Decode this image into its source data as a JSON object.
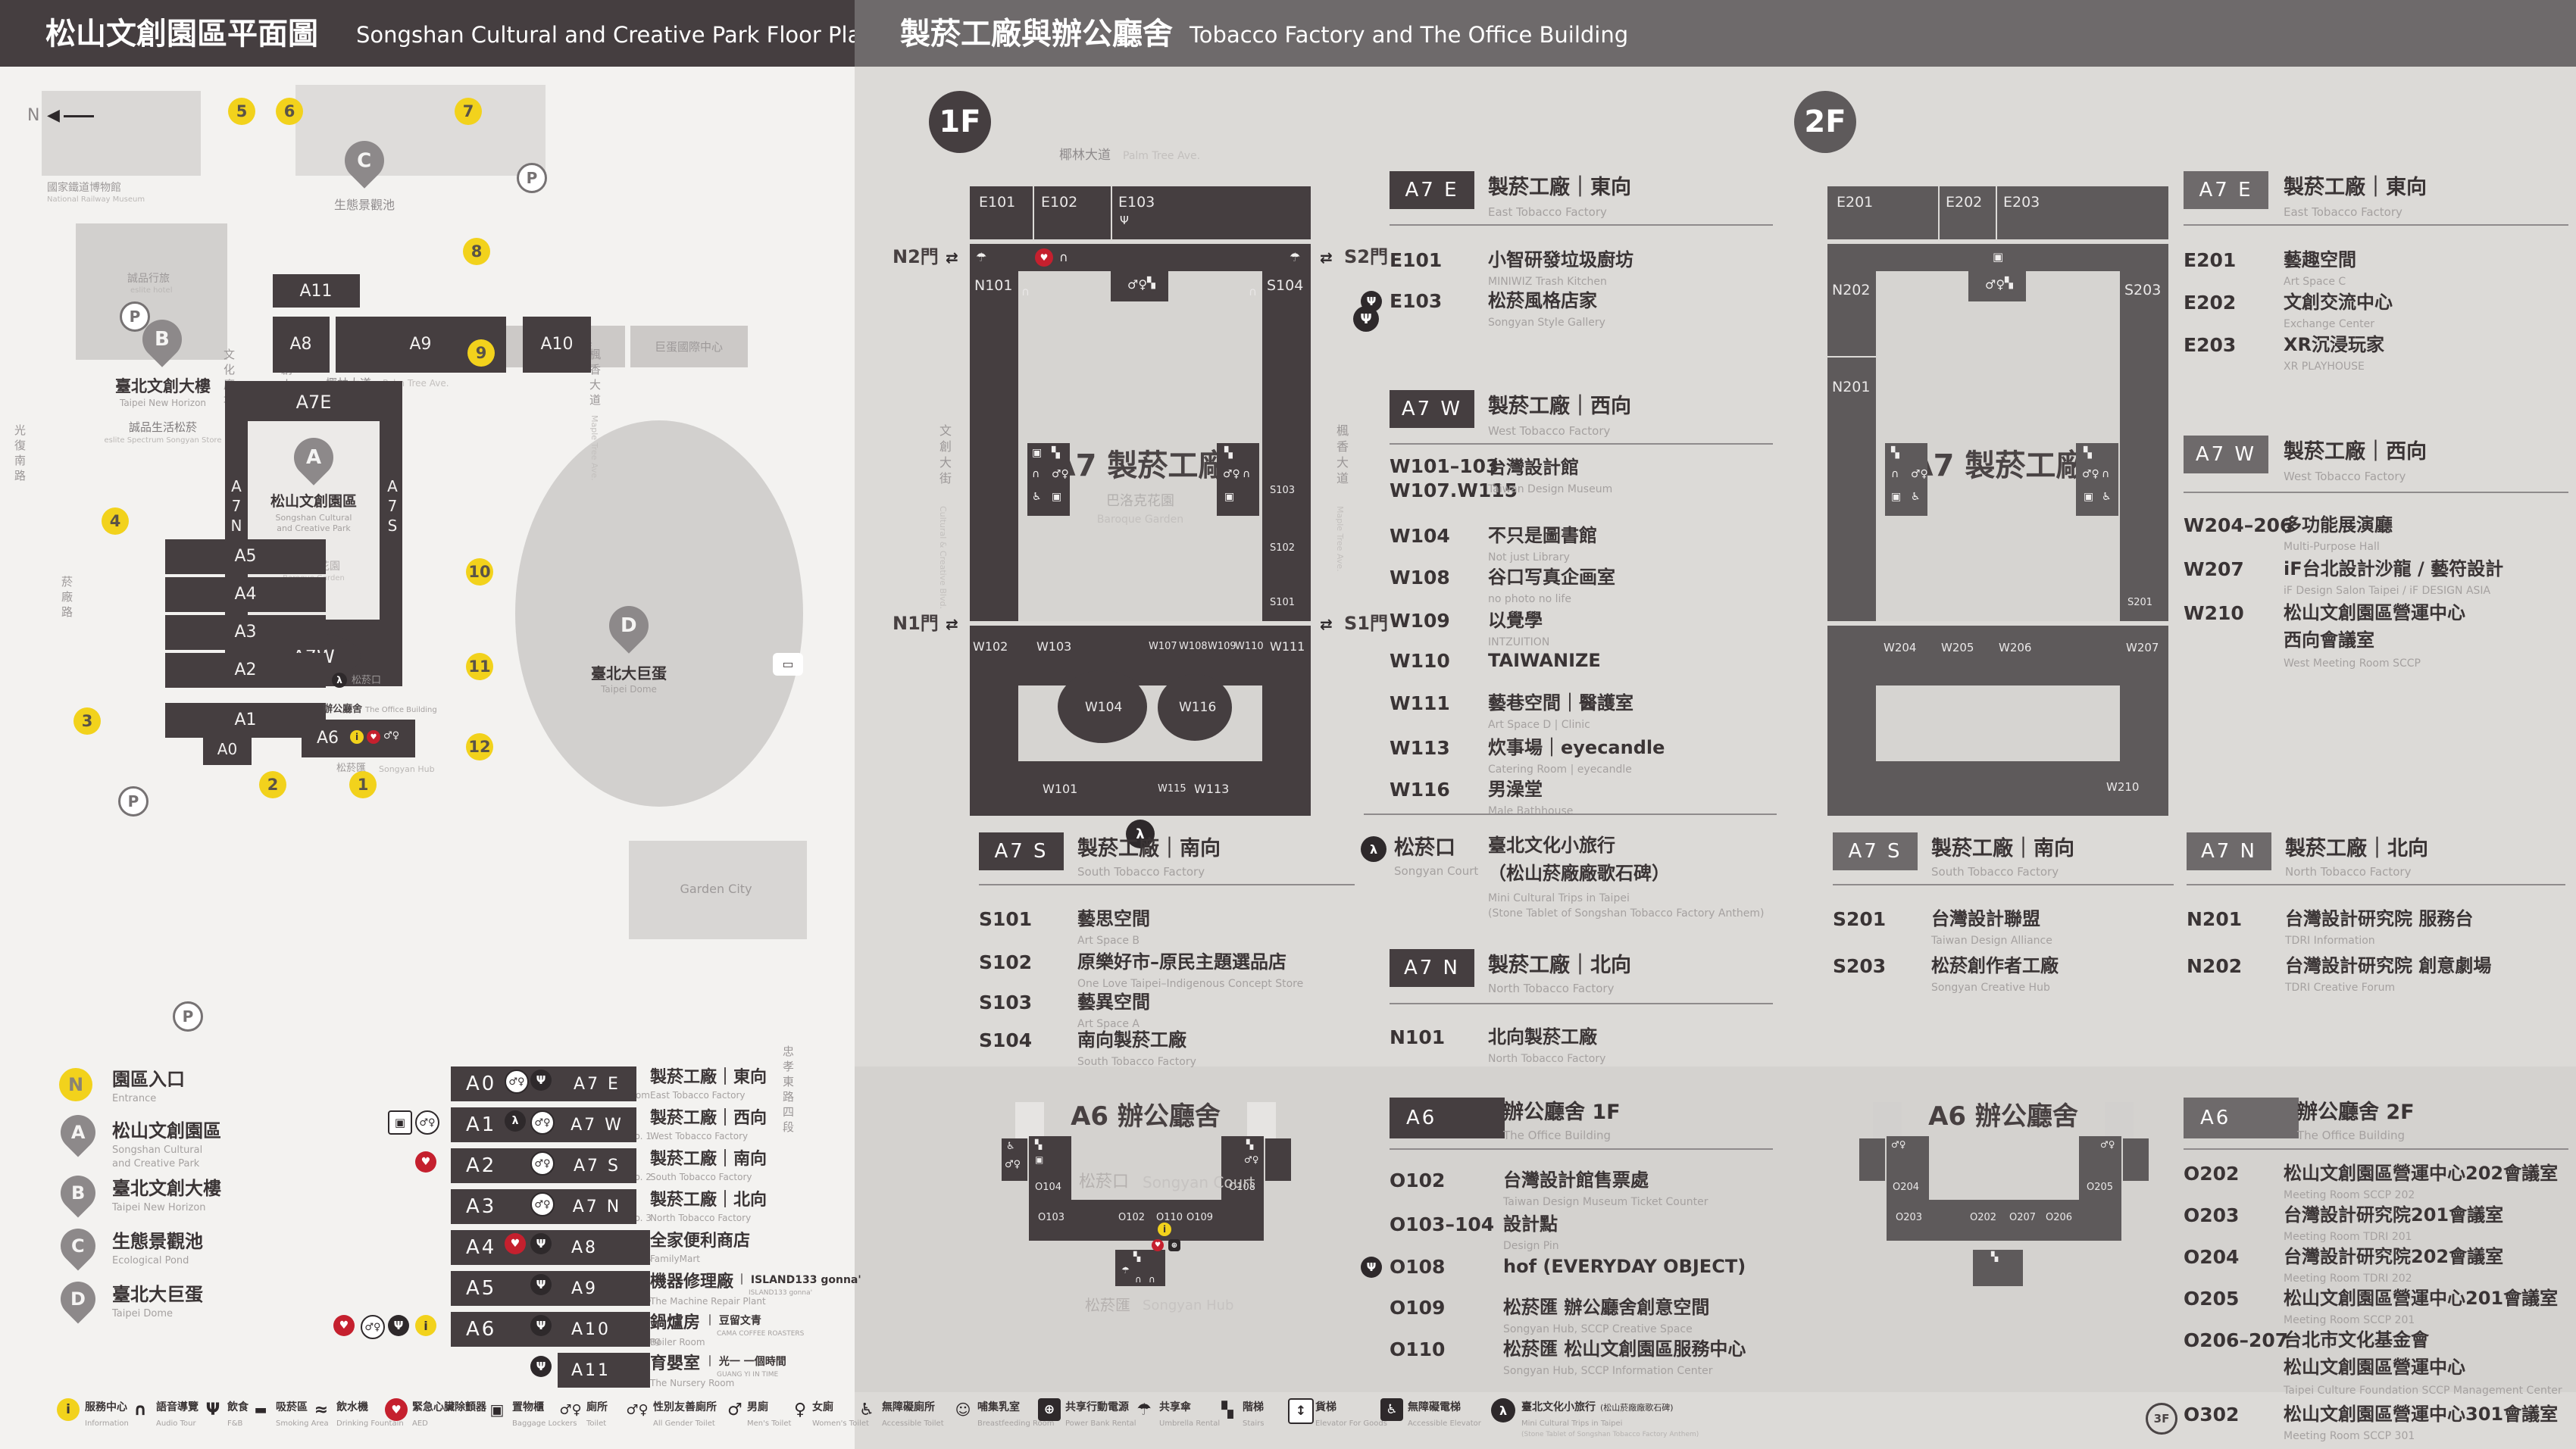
{
  "colors": {
    "header_left_bg": "#453e40",
    "header_right_bg": "#6e6a6b",
    "panel_left_bg": "#f3f2f0",
    "panel_right_bg": "#dcdad7",
    "building_dark": "#453e40",
    "building_gray": "#5e5a5b",
    "accent_yellow": "#f2d21c",
    "accent_red": "#c5202e",
    "text_dark": "#3a3435",
    "text_gray": "#a5a1a0"
  },
  "glyphs": {
    "fnb": "Ψ",
    "toilet": "♂♀",
    "men": "♂",
    "women": "♀",
    "acc": "♿",
    "aed": "♥",
    "info": "i",
    "audio": "∩",
    "locker": "▣",
    "umb": "☂",
    "stairs": "▚",
    "walk": "λ",
    "power": "⊕",
    "lift": "↕",
    "smoke": "▬",
    "fountain": "≈",
    "bf": "☺",
    "bus": "▭",
    "arrows": "⇄",
    "compass": "◀",
    "parking": "P"
  },
  "header": {
    "left_zh": "松山文創園區平面圖",
    "left_en": "Songshan Cultural and Creative Park Floor Plan",
    "right_zh": "製菸工廠與辦公廳舍",
    "right_en": "Tobacco Factory and The Office Building"
  },
  "park": {
    "compass": "N",
    "railway_zh": "國家鐵道博物館",
    "railway_en": "National Railway Museum",
    "eslite_hotel_zh": "誠品行旅",
    "eslite_hotel_en": "eslite hotel",
    "b_title_zh": "臺北文創大樓",
    "b_title_en": "Taipei New Horizon",
    "b_sub_zh": "誠品生活松菸",
    "b_sub_en": "eslite Spectrum Songyan Store",
    "c_title_zh": "生態景觀池",
    "d_title_zh": "臺北大巨蛋",
    "d_title_en": "Taipei Dome",
    "hotel_zh": "臺北洲際酒店",
    "dome_center_zh": "巨蛋國際中心",
    "garden_city": "Garden City",
    "st_palm_zh": "椰林大道",
    "st_palm_en": "Palm Tree Ave.",
    "st_cultural_blvd_zh": "文創大街",
    "st_cultural_blvd_en": "Cultural & Creative Blvd.",
    "st_cultural_plaza_zh": "文化廣場",
    "st_cultural_plaza_en": "Cultural Plaza",
    "st_maple_zh": "楓香大道",
    "st_maple_en": "Maple Tree Ave.",
    "st_yanchang_zh": "菸廠路",
    "st_guangfu_zh": "光復南路",
    "st_zhongxiao_zh": "忠孝東路四段",
    "court_zh": "松菸口",
    "hub_zh": "松菸匯",
    "hub_en": "Songyan Hub",
    "office_zh": "辦公廳舍",
    "office_en": "The Office Building",
    "a_pin_zh": "松山文創園區",
    "a_pin_en1": "Songshan Cultural",
    "a_pin_en2": "and Creative Park",
    "baroque_zh": "巴洛克花園",
    "baroque_en": "Baroque Garden",
    "pins": {
      "a": "A",
      "b": "B",
      "c": "C",
      "d": "D"
    },
    "bldg": {
      "a11": "A11",
      "a8": "A8",
      "a9": "A9",
      "a10": "A10",
      "a7e": "A7E",
      "a7w": "A7W",
      "a7n": "A7N",
      "a7s": "A7S",
      "a5": "A5",
      "a4": "A4",
      "a3": "A3",
      "a2": "A2",
      "a1": "A1",
      "a0": "A0",
      "a6": "A6"
    },
    "nums": [
      "1",
      "2",
      "3",
      "4",
      "5",
      "6",
      "7",
      "8",
      "9",
      "10",
      "11",
      "12"
    ]
  },
  "legend": {
    "markers": [
      {
        "sym": "N",
        "zh": "園區入口",
        "en1": "Entrance",
        "en2": ""
      },
      {
        "sym": "A",
        "zh": "松山文創園區",
        "en1": "Songshan Cultural",
        "en2": "and Creative Park"
      },
      {
        "sym": "B",
        "zh": "臺北文創大樓",
        "en1": "Taipei New Horizon",
        "en2": ""
      },
      {
        "sym": "C",
        "zh": "生態景觀池",
        "en1": "Ecological Pond",
        "en2": ""
      },
      {
        "sym": "D",
        "zh": "臺北大巨蛋",
        "en1": "Taipei Dome",
        "en2": ""
      }
    ],
    "col2": [
      {
        "code": "A0",
        "zh": "檢查室",
        "en": "Inspection Room"
      },
      {
        "code": "A1",
        "zh": "1號倉庫",
        "en": "Warehouse No. 1"
      },
      {
        "code": "A2",
        "zh": "2號倉庫",
        "en": "Warehouse No. 2"
      },
      {
        "code": "A3",
        "zh": "3號倉庫",
        "en": "Warehouse No. 3"
      },
      {
        "code": "A4",
        "zh": "4號倉庫",
        "en": "Warehouse No. 4"
      },
      {
        "code": "A5",
        "zh": "5號倉庫",
        "en": "Warehouse No. 5"
      },
      {
        "code": "A6",
        "zh": "辦公廳舍",
        "en": "The Office Building"
      }
    ],
    "col3": [
      {
        "code": "A7 E",
        "zh": "製菸工廠｜東向",
        "en": "East Tobacco Factory"
      },
      {
        "code": "A7 W",
        "zh": "製菸工廠｜西向",
        "en": "West Tobacco Factory"
      },
      {
        "code": "A7 S",
        "zh": "製菸工廠｜南向",
        "en": "South Tobacco Factory"
      },
      {
        "code": "A7 N",
        "zh": "製菸工廠｜北向",
        "en": "North Tobacco Factory"
      },
      {
        "code": "A8",
        "zh": "全家便利商店",
        "en": "FamilyMart"
      },
      {
        "code": "A9",
        "zh": "機器修理廠",
        "brand": "｜ ISLAND133 gonna'",
        "brand2": "ISLAND133 gonna'",
        "en": "The Machine Repair Plant"
      },
      {
        "code": "A10",
        "zh": "鍋爐房",
        "brand": "｜ 豆留文青",
        "brand2": "CAMA COFFEE ROASTERS",
        "en": "Boiler Room"
      },
      {
        "code": "A11",
        "zh": "育嬰室",
        "brand": "｜ 光一 一個時間",
        "brand2": "GUANG YI IN TIME",
        "en": "The Nursery Room"
      }
    ]
  },
  "facilities": [
    {
      "zh": "服務中心",
      "en": "Information"
    },
    {
      "zh": "語音導覽",
      "en": "Audio Tour"
    },
    {
      "zh": "飲食",
      "en": "F&B"
    },
    {
      "zh": "吸菸區",
      "en": "Smoking Area"
    },
    {
      "zh": "飲水機",
      "en": "Drinking Fountain"
    },
    {
      "zh": "緊急心臟除顫器",
      "en": "AED"
    },
    {
      "zh": "置物櫃",
      "en": "Baggage Lockers"
    },
    {
      "zh": "廁所",
      "en": "Toilet"
    },
    {
      "zh": "性別友善廁所",
      "en": "All Gender Toilet"
    },
    {
      "zh": "男廁",
      "en": "Men's Toilet"
    },
    {
      "zh": "女廁",
      "en": "Women's Toilet"
    },
    {
      "zh": "無障礙廁所",
      "en": "Accessible Toilet"
    },
    {
      "zh": "哺集乳室",
      "en": "Breastfeeding Room"
    },
    {
      "zh": "共享行動電源",
      "en": "Power Bank Rental"
    },
    {
      "zh": "共享傘",
      "en": "Umbrella Rental"
    },
    {
      "zh": "階梯",
      "en": "Stairs"
    },
    {
      "zh": "貨梯",
      "en": "Elevator For Goods"
    },
    {
      "zh": "無障礙電梯",
      "en": "Accessible Elevator"
    },
    {
      "zh": "臺北文化小旅行",
      "zh2": "(松山菸廠廠歌石碑)",
      "en": "Mini Cultural Trips in Taipei",
      "en2": "(Stone Tablet of Songshan Tobacco Factory Anthem)"
    }
  ],
  "f1": {
    "badge": "1F",
    "map": {
      "street_top_zh": "椰林大道",
      "street_top_en": "Palm Tree Ave.",
      "street_left_zh": "文創大街",
      "street_left_en": "Cultural & Creative Blvd.",
      "street_right_zh": "楓香大道",
      "street_right_en": "Maple Tree Ave.",
      "gate_n2": "N2門",
      "gate_s2": "S2門",
      "gate_n1": "N1門",
      "gate_s1": "S1門",
      "center": "A7 製菸工廠",
      "garden_zh": "巴洛克花園",
      "garden_en": "Baroque Garden",
      "rooms": {
        "e101": "E101",
        "e102": "E102",
        "e103": "E103",
        "n101": "N101",
        "s104": "S104",
        "s103": "S103",
        "s102": "S102",
        "s101": "S101",
        "w102": "W102",
        "w103": "W103",
        "w104": "W104",
        "w107": "W107",
        "w108": "W108",
        "w109": "W109",
        "w110": "W110",
        "w111": "W111",
        "w116": "W116",
        "w101": "W101",
        "w115": "W115",
        "w113": "W113"
      }
    },
    "a7e": {
      "badge": "A7 E",
      "zh": "製菸工廠｜東向",
      "en": "East Tobacco Factory",
      "items": [
        {
          "code": "E101",
          "zh": "小智研發垃圾廚坊",
          "en": "MINIWIZ Trash Kitchen"
        },
        {
          "code": "E103",
          "zh": "松菸風格店家",
          "en": "Songyan Style Gallery"
        }
      ]
    },
    "a7w": {
      "badge": "A7 W",
      "zh": "製菸工廠｜西向",
      "en": "West Tobacco Factory",
      "items": [
        {
          "code": "W101–103",
          "code2": "W107.W115",
          "zh": "台灣設計館",
          "en": "Taiwan Design Museum"
        },
        {
          "code": "W104",
          "zh": "不只是圖書館",
          "en": "Not just Library"
        },
        {
          "code": "W108",
          "zh": "谷口写真企画室",
          "en": "no photo no life"
        },
        {
          "code": "W109",
          "zh": "以覺學",
          "en": "INTZUITION"
        },
        {
          "code": "W110",
          "zh": "TAIWANIZE",
          "en": ""
        },
        {
          "code": "W111",
          "zh": "藝巷空間｜醫護室",
          "en": "Art Space D | Clinic"
        },
        {
          "code": "W113",
          "zh": "炊事場｜eyecandle",
          "en": "Catering Room | eyecandle"
        },
        {
          "code": "W116",
          "zh": "男澡堂",
          "en": "Male Bathhouse"
        }
      ]
    },
    "a7s": {
      "badge": "A7 S",
      "zh": "製菸工廠｜南向",
      "en": "South Tobacco Factory",
      "items": [
        {
          "code": "S101",
          "zh": "藝思空間",
          "en": "Art Space B"
        },
        {
          "code": "S102",
          "zh": "原樂好市–原民主題選品店",
          "en": "One Love Taipei–Indigenous Concept Store"
        },
        {
          "code": "S103",
          "zh": "藝異空間",
          "en": "Art Space A"
        },
        {
          "code": "S104",
          "zh": "南向製菸工廠",
          "en": "South Tobacco Factory"
        }
      ]
    },
    "court": {
      "zh": "松菸口",
      "en": "Songyan Court",
      "item_zh1": "臺北文化小旅行",
      "item_zh2": "（松山菸廠廠歌石碑）",
      "item_en1": "Mini Cultural Trips in Taipei",
      "item_en2": "(Stone Tablet of Songshan Tobacco Factory Anthem)"
    },
    "a7n": {
      "badge": "A7 N",
      "zh": "製菸工廠｜北向",
      "en": "North Tobacco Factory",
      "items": [
        {
          "code": "N101",
          "zh": "北向製菸工廠",
          "en": "North Tobacco Factory"
        }
      ]
    },
    "a6": {
      "badge": "A6",
      "zh": "辦公廳舍 1F",
      "en": "The Office Building",
      "map_title": "A6 辦公廳舍",
      "court_zh": "松菸口",
      "court_en": "Songyan Court",
      "hub_zh": "松菸匯",
      "hub_en": "Songyan Hub",
      "rooms": {
        "o104": "O104",
        "o103": "O103",
        "o102": "O102",
        "o110": "O110",
        "o109": "O109",
        "o108": "O108"
      },
      "items": [
        {
          "code": "O102",
          "zh": "台灣設計館售票處",
          "en": "Taiwan Design Museum Ticket Counter"
        },
        {
          "code": "O103–104",
          "zh": "設計點",
          "en": "Design Pin"
        },
        {
          "code": "O108",
          "zh": "hof (EVERYDAY OBJECT)",
          "en": ""
        },
        {
          "code": "O109",
          "zh": "松菸匯 辦公廳舍創意空間",
          "en": "Songyan Hub, SCCP Creative Space"
        },
        {
          "code": "O110",
          "zh": "松菸匯 松山文創園區服務中心",
          "en": "Songyan Hub, SCCP Information Center"
        }
      ]
    }
  },
  "f2": {
    "badge": "2F",
    "map": {
      "center": "A7 製菸工廠",
      "rooms": {
        "e201": "E201",
        "e202": "E202",
        "e203": "E203",
        "n202": "N202",
        "n201": "N201",
        "s203": "S203",
        "s201": "S201",
        "w204": "W204",
        "w205": "W205",
        "w206": "W206",
        "w207": "W207",
        "w210": "W210"
      }
    },
    "a7e": {
      "badge": "A7 E",
      "zh": "製菸工廠｜東向",
      "en": "East Tobacco Factory",
      "items": [
        {
          "code": "E201",
          "zh": "藝趣空間",
          "en": "Art Space C"
        },
        {
          "code": "E202",
          "zh": "文創交流中心",
          "en": "Exchange Center"
        },
        {
          "code": "E203",
          "zh": "XR沉浸玩家",
          "en": "XR PLAYHOUSE"
        }
      ]
    },
    "a7w": {
      "badge": "A7 W",
      "zh": "製菸工廠｜西向",
      "en": "West Tobacco Factory",
      "items": [
        {
          "code": "W204–206",
          "zh": "多功能展演廳",
          "en": "Multi-Purpose Hall"
        },
        {
          "code": "W207",
          "zh": "iF台北設計沙龍 / 藝符設計",
          "en": "iF Design Salon Taipei / iF DESIGN ASIA"
        },
        {
          "code": "W210",
          "zh": "松山文創園區營運中心",
          "zh2": "西向會議室",
          "en": "West Meeting Room SCCP"
        }
      ]
    },
    "a7s": {
      "badge": "A7 S",
      "zh": "製菸工廠｜南向",
      "en": "South Tobacco Factory",
      "items": [
        {
          "code": "S201",
          "zh": "台灣設計聯盟",
          "en": "Taiwan Design Alliance"
        },
        {
          "code": "S203",
          "zh": "松菸創作者工廠",
          "en": "Songyan Creative Hub"
        }
      ]
    },
    "a7n": {
      "badge": "A7 N",
      "zh": "製菸工廠｜北向",
      "en": "North Tobacco Factory",
      "items": [
        {
          "code": "N201",
          "zh": "台灣設計研究院 服務台",
          "en": "TDRI Information"
        },
        {
          "code": "N202",
          "zh": "台灣設計研究院 創意劇場",
          "en": "TDRI Creative Forum"
        }
      ]
    },
    "a6": {
      "badge": "A6",
      "zh": "辦公廳舍 2F",
      "en": "The Office Building",
      "map_title": "A6 辦公廳舍",
      "rooms": {
        "o204": "O204",
        "o203": "O203",
        "o202": "O202",
        "o207": "O207",
        "o206": "O206",
        "o205": "O205"
      },
      "items": [
        {
          "code": "O202",
          "zh": "松山文創園區營運中心202會議室",
          "en": "Meeting Room SCCP 202"
        },
        {
          "code": "O203",
          "zh": "台灣設計研究院201會議室",
          "en": "Meeting Room TDRI 201"
        },
        {
          "code": "O204",
          "zh": "台灣設計研究院202會議室",
          "en": "Meeting Room TDRI 202"
        },
        {
          "code": "O205",
          "zh": "松山文創園區營運中心201會議室",
          "en": "Meeting Room SCCP 201"
        },
        {
          "code": "O206–207",
          "zh": "台北市文化基金會",
          "zh2": "松山文創園區營運中心",
          "en": "Taipei Culture Foundation SCCP Management Center"
        },
        {
          "code": "O302",
          "zh": "松山文創園區營運中心301會議室",
          "en": "Meeting Room SCCP 301",
          "badge": "3F"
        }
      ]
    }
  }
}
